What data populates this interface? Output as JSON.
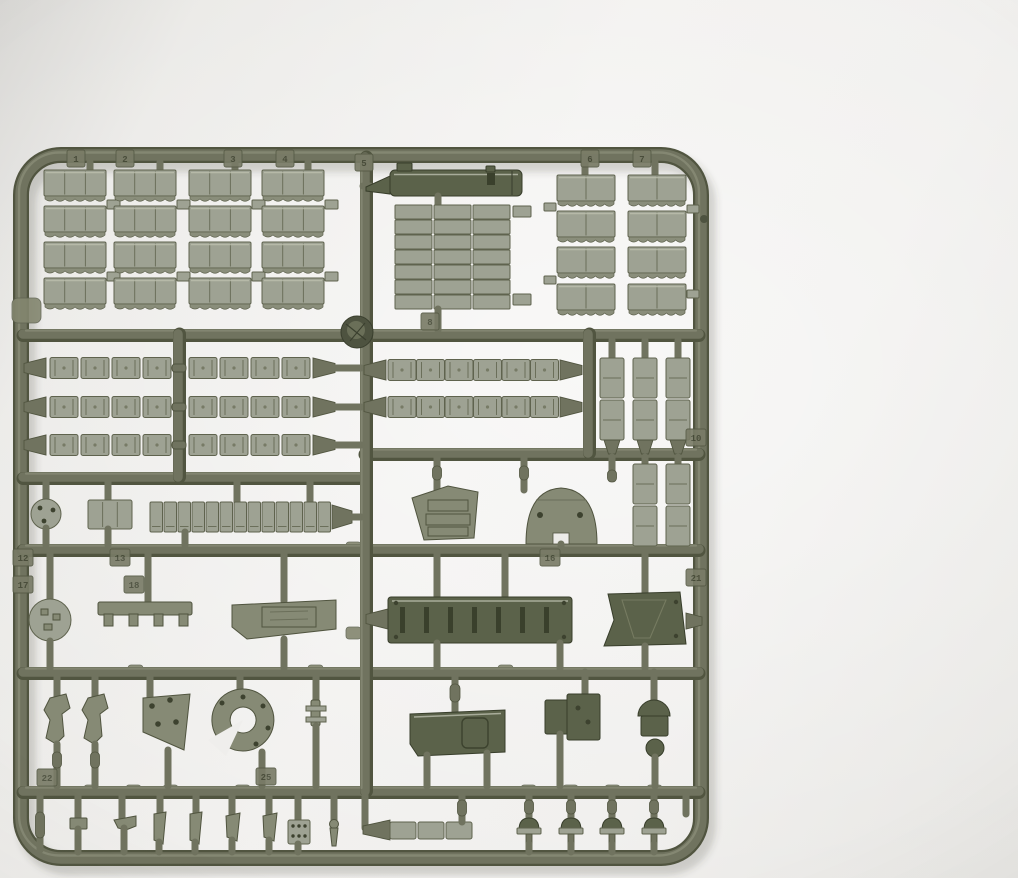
{
  "scene": {
    "alt": "Photograph of an olive-drab injection-molded plastic model kit sprue (parts tree) lying on a plain light background. The square runner frame holds tank-model parts: stacked track-pad sections, rows and strips of track links, a gun barrel, slotted hull plates, a glacis plate, road-wheel caps, a domed hatch, brackets, hooks, a storage panel and many small fittings. Small molded number tabs identify the parts."
  },
  "colors": {
    "background-left": "#d6d5d2",
    "background-center": "#f1f0ee",
    "background-right": "#e6e5e2",
    "runner": "#70735f",
    "runner-shadow": "#515540",
    "runner-highlight": "#8f927d",
    "part-light": "#9ea293",
    "part-mid": "#868a75",
    "part-dark": "#5b624a",
    "tag-face": "#797c67",
    "tag-text": "#474b38"
  },
  "tags": [
    {
      "label": "1"
    },
    {
      "label": "2"
    },
    {
      "label": "3"
    },
    {
      "label": "4"
    },
    {
      "label": "5"
    },
    {
      "label": "6"
    },
    {
      "label": "7"
    },
    {
      "label": "8"
    },
    {
      "label": "10"
    },
    {
      "label": "12"
    },
    {
      "label": "13"
    },
    {
      "label": "16"
    },
    {
      "label": "17"
    },
    {
      "label": "18"
    },
    {
      "label": "21"
    },
    {
      "label": "22"
    },
    {
      "label": "25"
    }
  ]
}
